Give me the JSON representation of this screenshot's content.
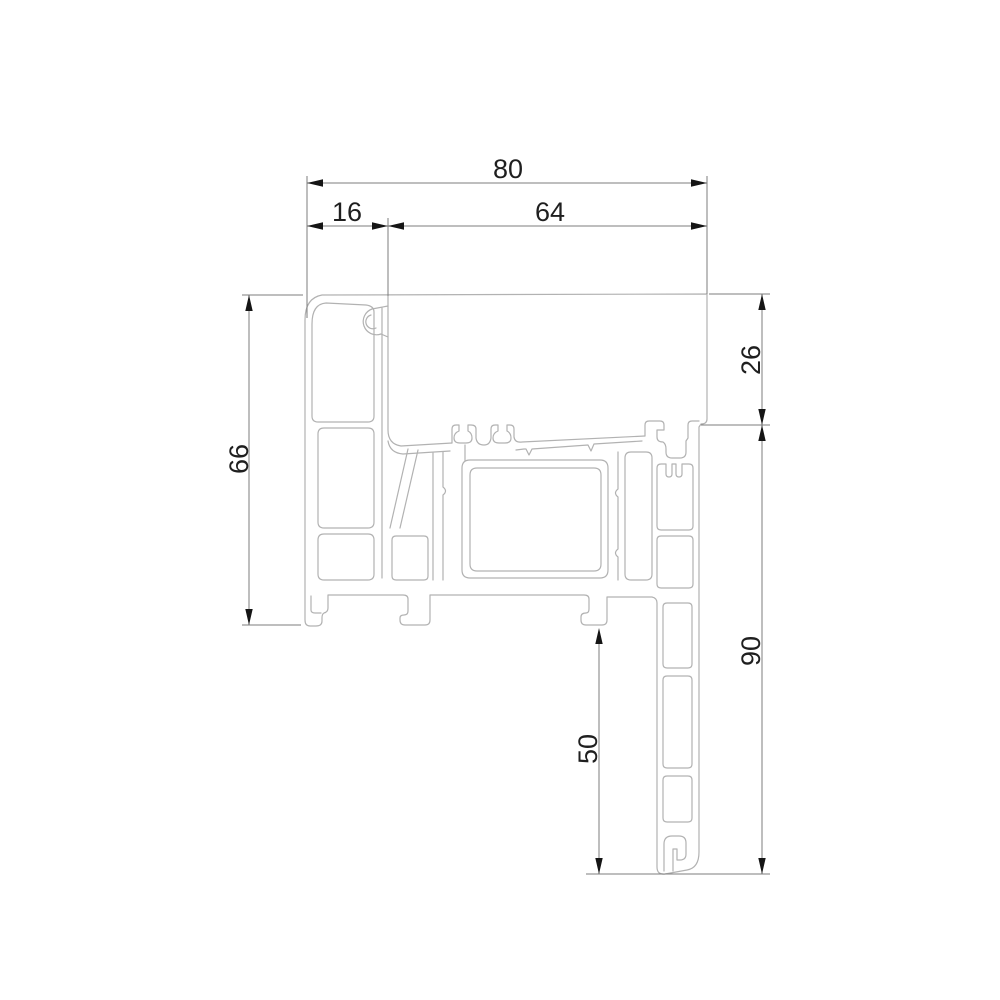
{
  "drawing": {
    "type": "window-profile-cross-section",
    "dimensions": {
      "top_total": "80",
      "top_left": "16",
      "top_right": "64",
      "left_height": "66",
      "right_upper": "26",
      "right_lower": "90",
      "bottom_inner": "50"
    },
    "colors": {
      "background": "#ffffff",
      "profile_line": "#b2b2b2",
      "dimension_line": "#7d7d7d",
      "arrow": "#151515",
      "text": "#1f1f1f"
    }
  }
}
